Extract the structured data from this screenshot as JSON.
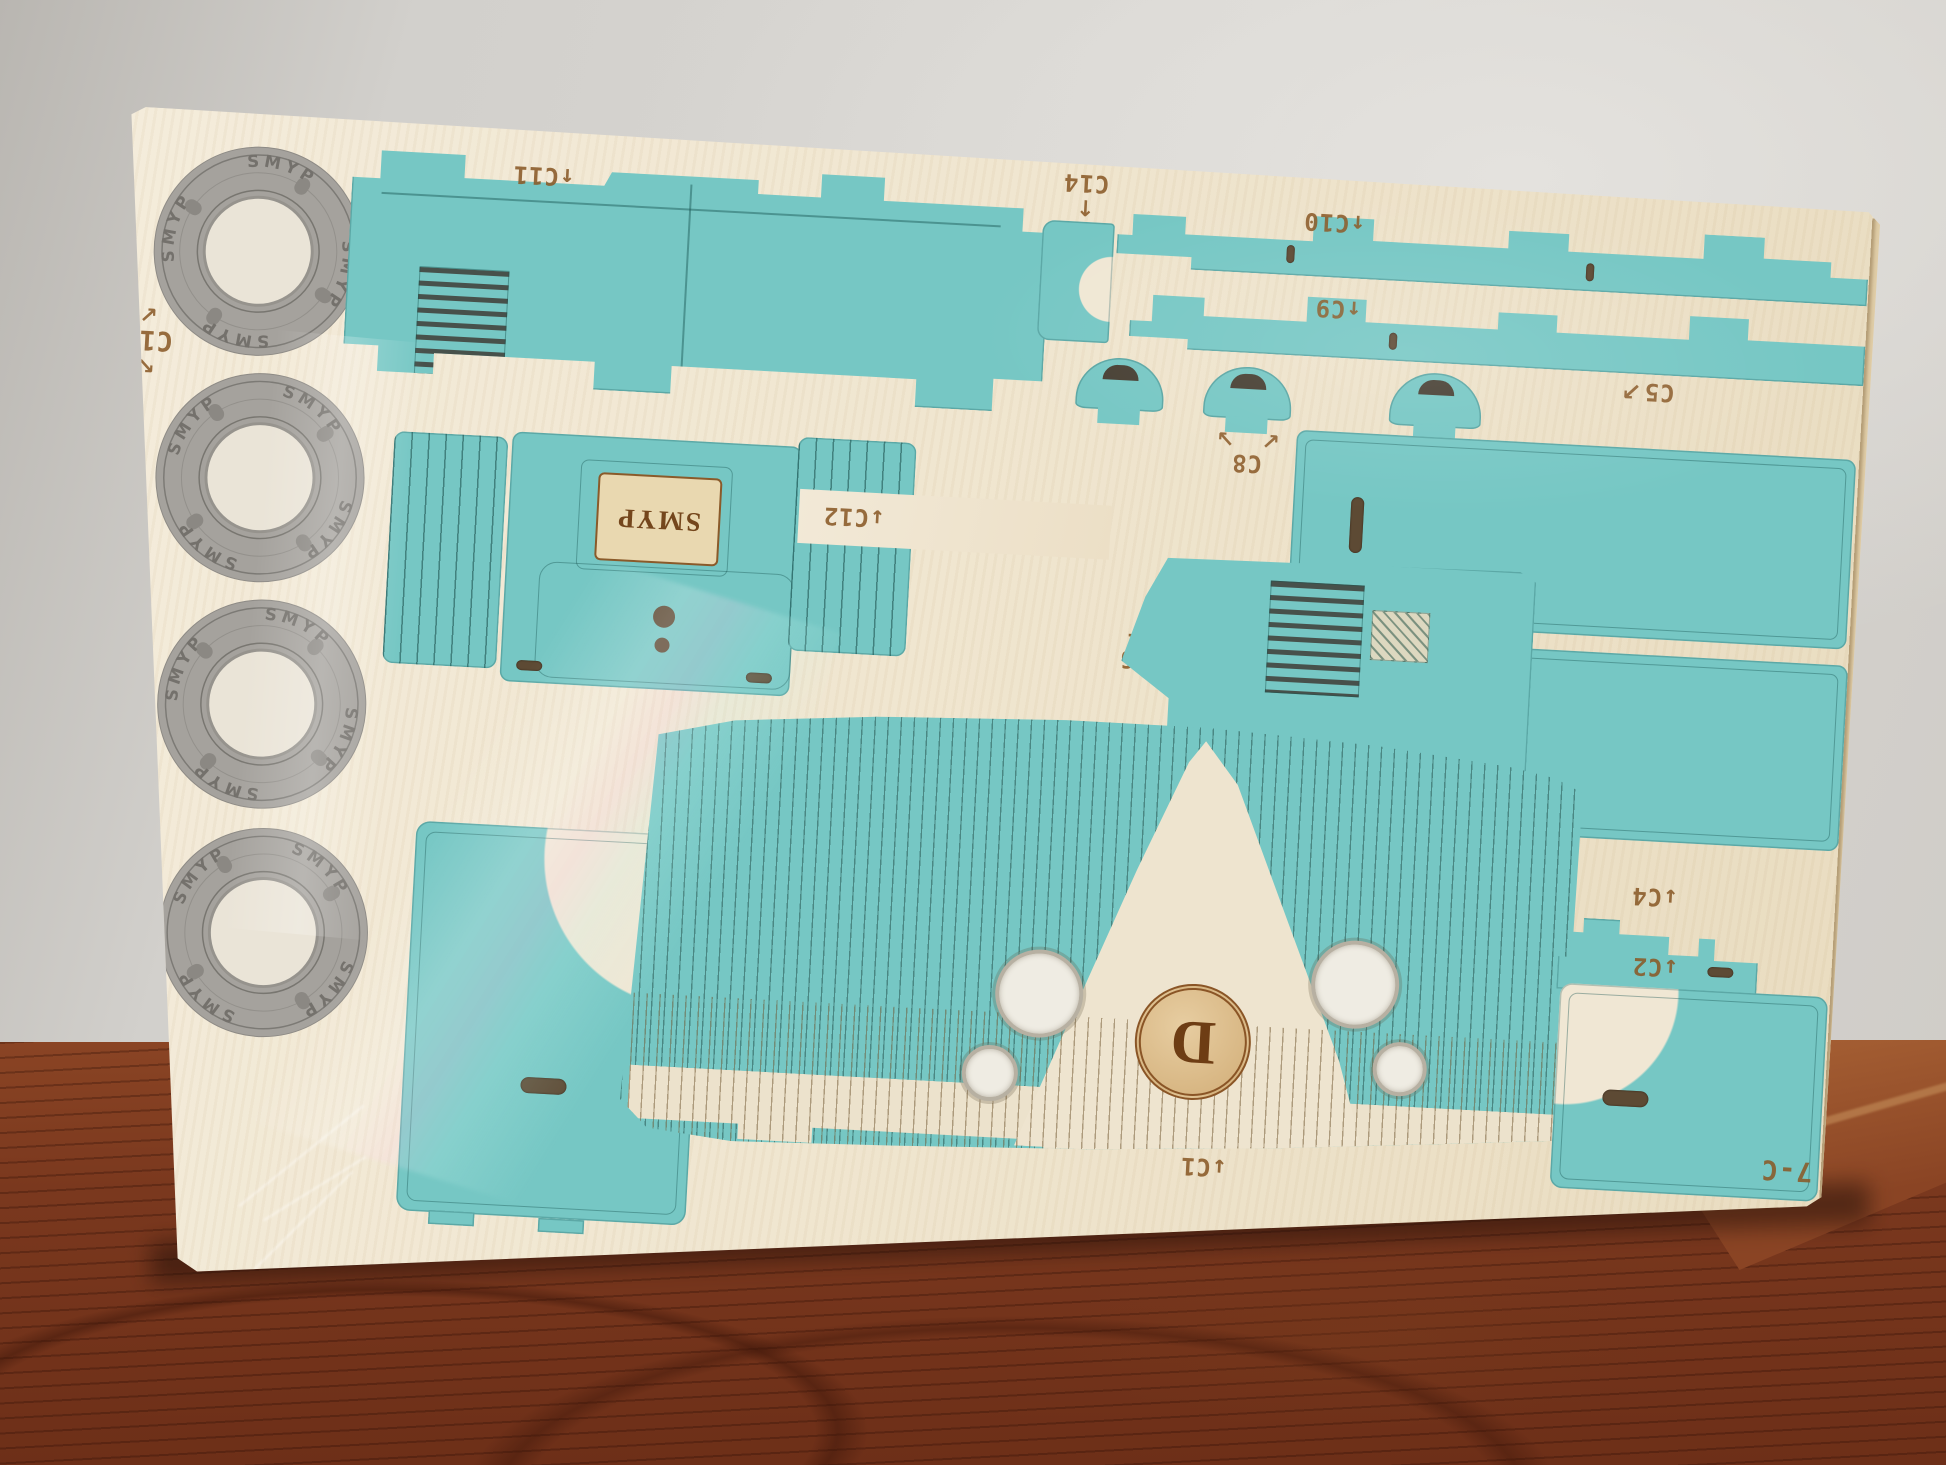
{
  "scene": {
    "type": "photograph",
    "subject": "Shrink-wrapped laser-cut plywood model-kit sheet (steam locomotive parts) leaning against a wall on a wooden table",
    "sheet_code": "7-C"
  },
  "brand": {
    "plate_text": "SMYP",
    "wheel_rim_text": "SMYP",
    "medallion_letter": "D"
  },
  "labels": {
    "c1": "↓C1",
    "c2": "↓C2",
    "c3": "↑C3",
    "c4": "↓C4",
    "c5": "C5",
    "c6": "C6",
    "c7": "C7",
    "c8": "C8",
    "c9": "↑C9",
    "c10": "↑C10",
    "c11": "↑C11",
    "c12": "↓C12",
    "c13": "↓C13",
    "c14": "C14",
    "c15": "C15",
    "sheet_code": "7-C"
  },
  "arrows": {
    "c5": "↗",
    "c6": "←",
    "c7_left": "↙",
    "c7_right": "↘",
    "c8_left": "↙",
    "c8_right": "↘",
    "c14": "↑",
    "c15_up": "↖",
    "c15_down": "↙"
  },
  "colors": {
    "wall": "#d6d4d0",
    "table_wood": "#7c3a20",
    "board_wood": "#f0e7d4",
    "piece_teal": "#76c7c4",
    "wheel_gray": "#a5a29d",
    "engraving_brown": "#8a5a28",
    "cut_line": "#2a6e6e"
  }
}
